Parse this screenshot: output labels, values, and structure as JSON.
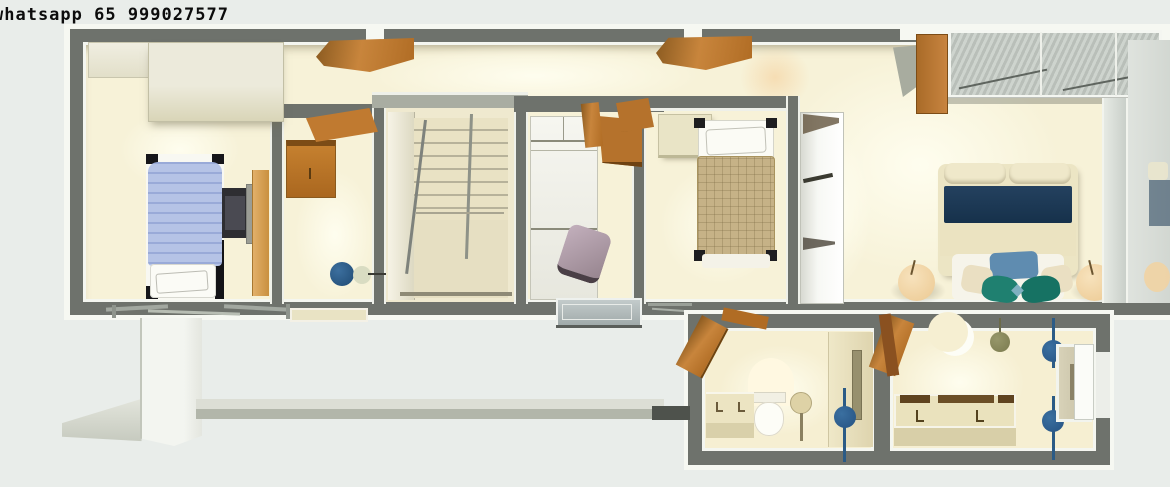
{
  "watermark": {
    "text": "whatsapp 65 999027577"
  },
  "scene": {
    "type": "3d-floor-plan-top-view-render",
    "floor": "upper floor of a house",
    "rooms": [
      {
        "name": "bedroom-left",
        "furniture": [
          "wardrobe",
          "single-bed-blue",
          "desk-with-monitor",
          "side-runner",
          "casement-windows"
        ]
      },
      {
        "name": "office-nook",
        "furniture": [
          "wall-cabinet-wood",
          "wall-shelf-wood",
          "desk-chair-blue"
        ]
      },
      {
        "name": "staircase",
        "furniture": [
          "stair-treads",
          "handrails"
        ]
      },
      {
        "name": "hall-closet",
        "furniture": [
          "wardrobe-cabinets",
          "wall-shelf-wood",
          "desk-chair-purple",
          "open-window"
        ]
      },
      {
        "name": "bedroom-middle",
        "furniture": [
          "single-bed-tan",
          "headboard-shelf",
          "wall-shelf-wood",
          "partition-wall"
        ]
      },
      {
        "name": "closet-corridor",
        "furniture": [
          "wardrobe-units"
        ]
      },
      {
        "name": "master-bedroom",
        "furniture": [
          "double-bed-navy-band",
          "nightstand-round-left",
          "nightstand-round-right",
          "glass-top-wardrobe",
          "wood-cabinet",
          "glass-partition"
        ]
      },
      {
        "name": "bathroom-1",
        "furniture": [
          "vanity-sink",
          "toilet",
          "pedestal-stand",
          "towel-pole-blue",
          "open-door-wood"
        ]
      },
      {
        "name": "bathroom-2",
        "furniture": [
          "double-vanity",
          "crescent-mirror",
          "shower-head",
          "towel-pole-blue-upper",
          "towel-pole-blue-lower",
          "mirror-niche",
          "white-door",
          "open-door-wood"
        ]
      }
    ],
    "open_doors": [
      "hallway-door-1",
      "hallway-door-2",
      "bathroom-1-door",
      "bathroom-2-door"
    ],
    "exterior": [
      "roof-eave-left",
      "white-pillar",
      "terrace-ledge"
    ]
  },
  "palette": {
    "background": "#e9edea",
    "wall_gray": "#6e726c",
    "trim_white": "#f6f8f2",
    "floor_cream": "#f8f3d9",
    "wood_orange": "#c07a30",
    "bed_blue": "#b5c3e6",
    "bed_tan": "#c6b287",
    "bed_navy": "#1c3a55",
    "pillow_teal": "#1f8070",
    "accent_steel_blue": "#2f6497",
    "chair_purple": "#b4a0ae",
    "ledge_gray": "#b2b6aa"
  }
}
